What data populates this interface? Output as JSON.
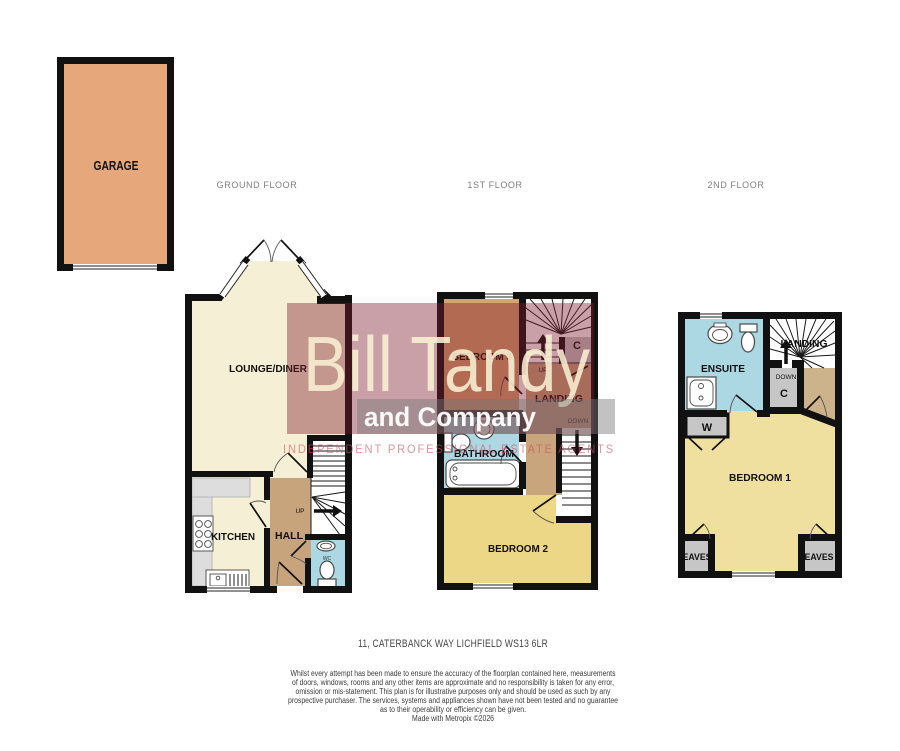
{
  "floor_titles": {
    "ground": "GROUND FLOOR",
    "first": "1ST FLOOR",
    "second": "2ND FLOOR"
  },
  "garage": {
    "label": "GARAGE"
  },
  "ground": {
    "lounge": "LOUNGE/DINER",
    "kitchen": "KITCHEN",
    "hall": "HALL",
    "up": "UP",
    "wc": "WC"
  },
  "first": {
    "bedroom3": "BEDROOM 3",
    "landing": "LANDING",
    "bathroom": "BATHROOM",
    "bedroom2": "BEDROOM 2",
    "cupboard": "C",
    "up": "UP",
    "down": "DOWN"
  },
  "second": {
    "ensuite": "ENSUITE",
    "landing": "LANDING",
    "bedroom1": "BEDROOM 1",
    "cupboard": "C",
    "wardrobe": "W",
    "down": "DOWN",
    "eaves_left": "EAVES",
    "eaves_right": "EAVES"
  },
  "watermark": {
    "name": "Bill Tandy",
    "company": "and Company",
    "tagline": "INDEPENDENT PROFESSIONAL ESTATE AGENTS"
  },
  "footer": {
    "address": "11, CATERBANCK WAY LICHFIELD WS13 6LR",
    "disclaimer": [
      "Whilst every attempt has been made to ensure the accuracy of the floorplan contained here, measurements",
      "of doors, windows, rooms and any other items are approximate and no responsibility is taken for any error,",
      "omission or mis-statement. This plan is for illustrative purposes only and should be used as such by any",
      "prospective purchaser. The services, systems and appliances shown have not been tested and no guarantee",
      "as to their operability or efficiency can be given.",
      "Made with Metropix ©2026"
    ]
  },
  "colors": {
    "wall": "#111111",
    "garage_fill": "#e6a87a",
    "cream": "#f5efd5",
    "hall_tan": "#c7a47b",
    "landing_tan": "#c8a57c",
    "lobby_tan": "#cdb38c",
    "blue": "#abd8e2",
    "bed3": "#d9a36e",
    "bed2": "#ecd787",
    "bed1": "#f0e0a0",
    "cupboard_gray": "#c6c6c6",
    "stairs_white": "#ffffff",
    "watermark_maroon": "rgba(126,28,46,0.42)",
    "watermark_cream": "rgba(248,240,212,0.88)",
    "watermark_band": "rgba(120,120,120,0.45)",
    "watermark_band_text": "rgba(255,255,255,0.95)",
    "watermark_pink": "rgba(201,84,97,0.62)"
  }
}
